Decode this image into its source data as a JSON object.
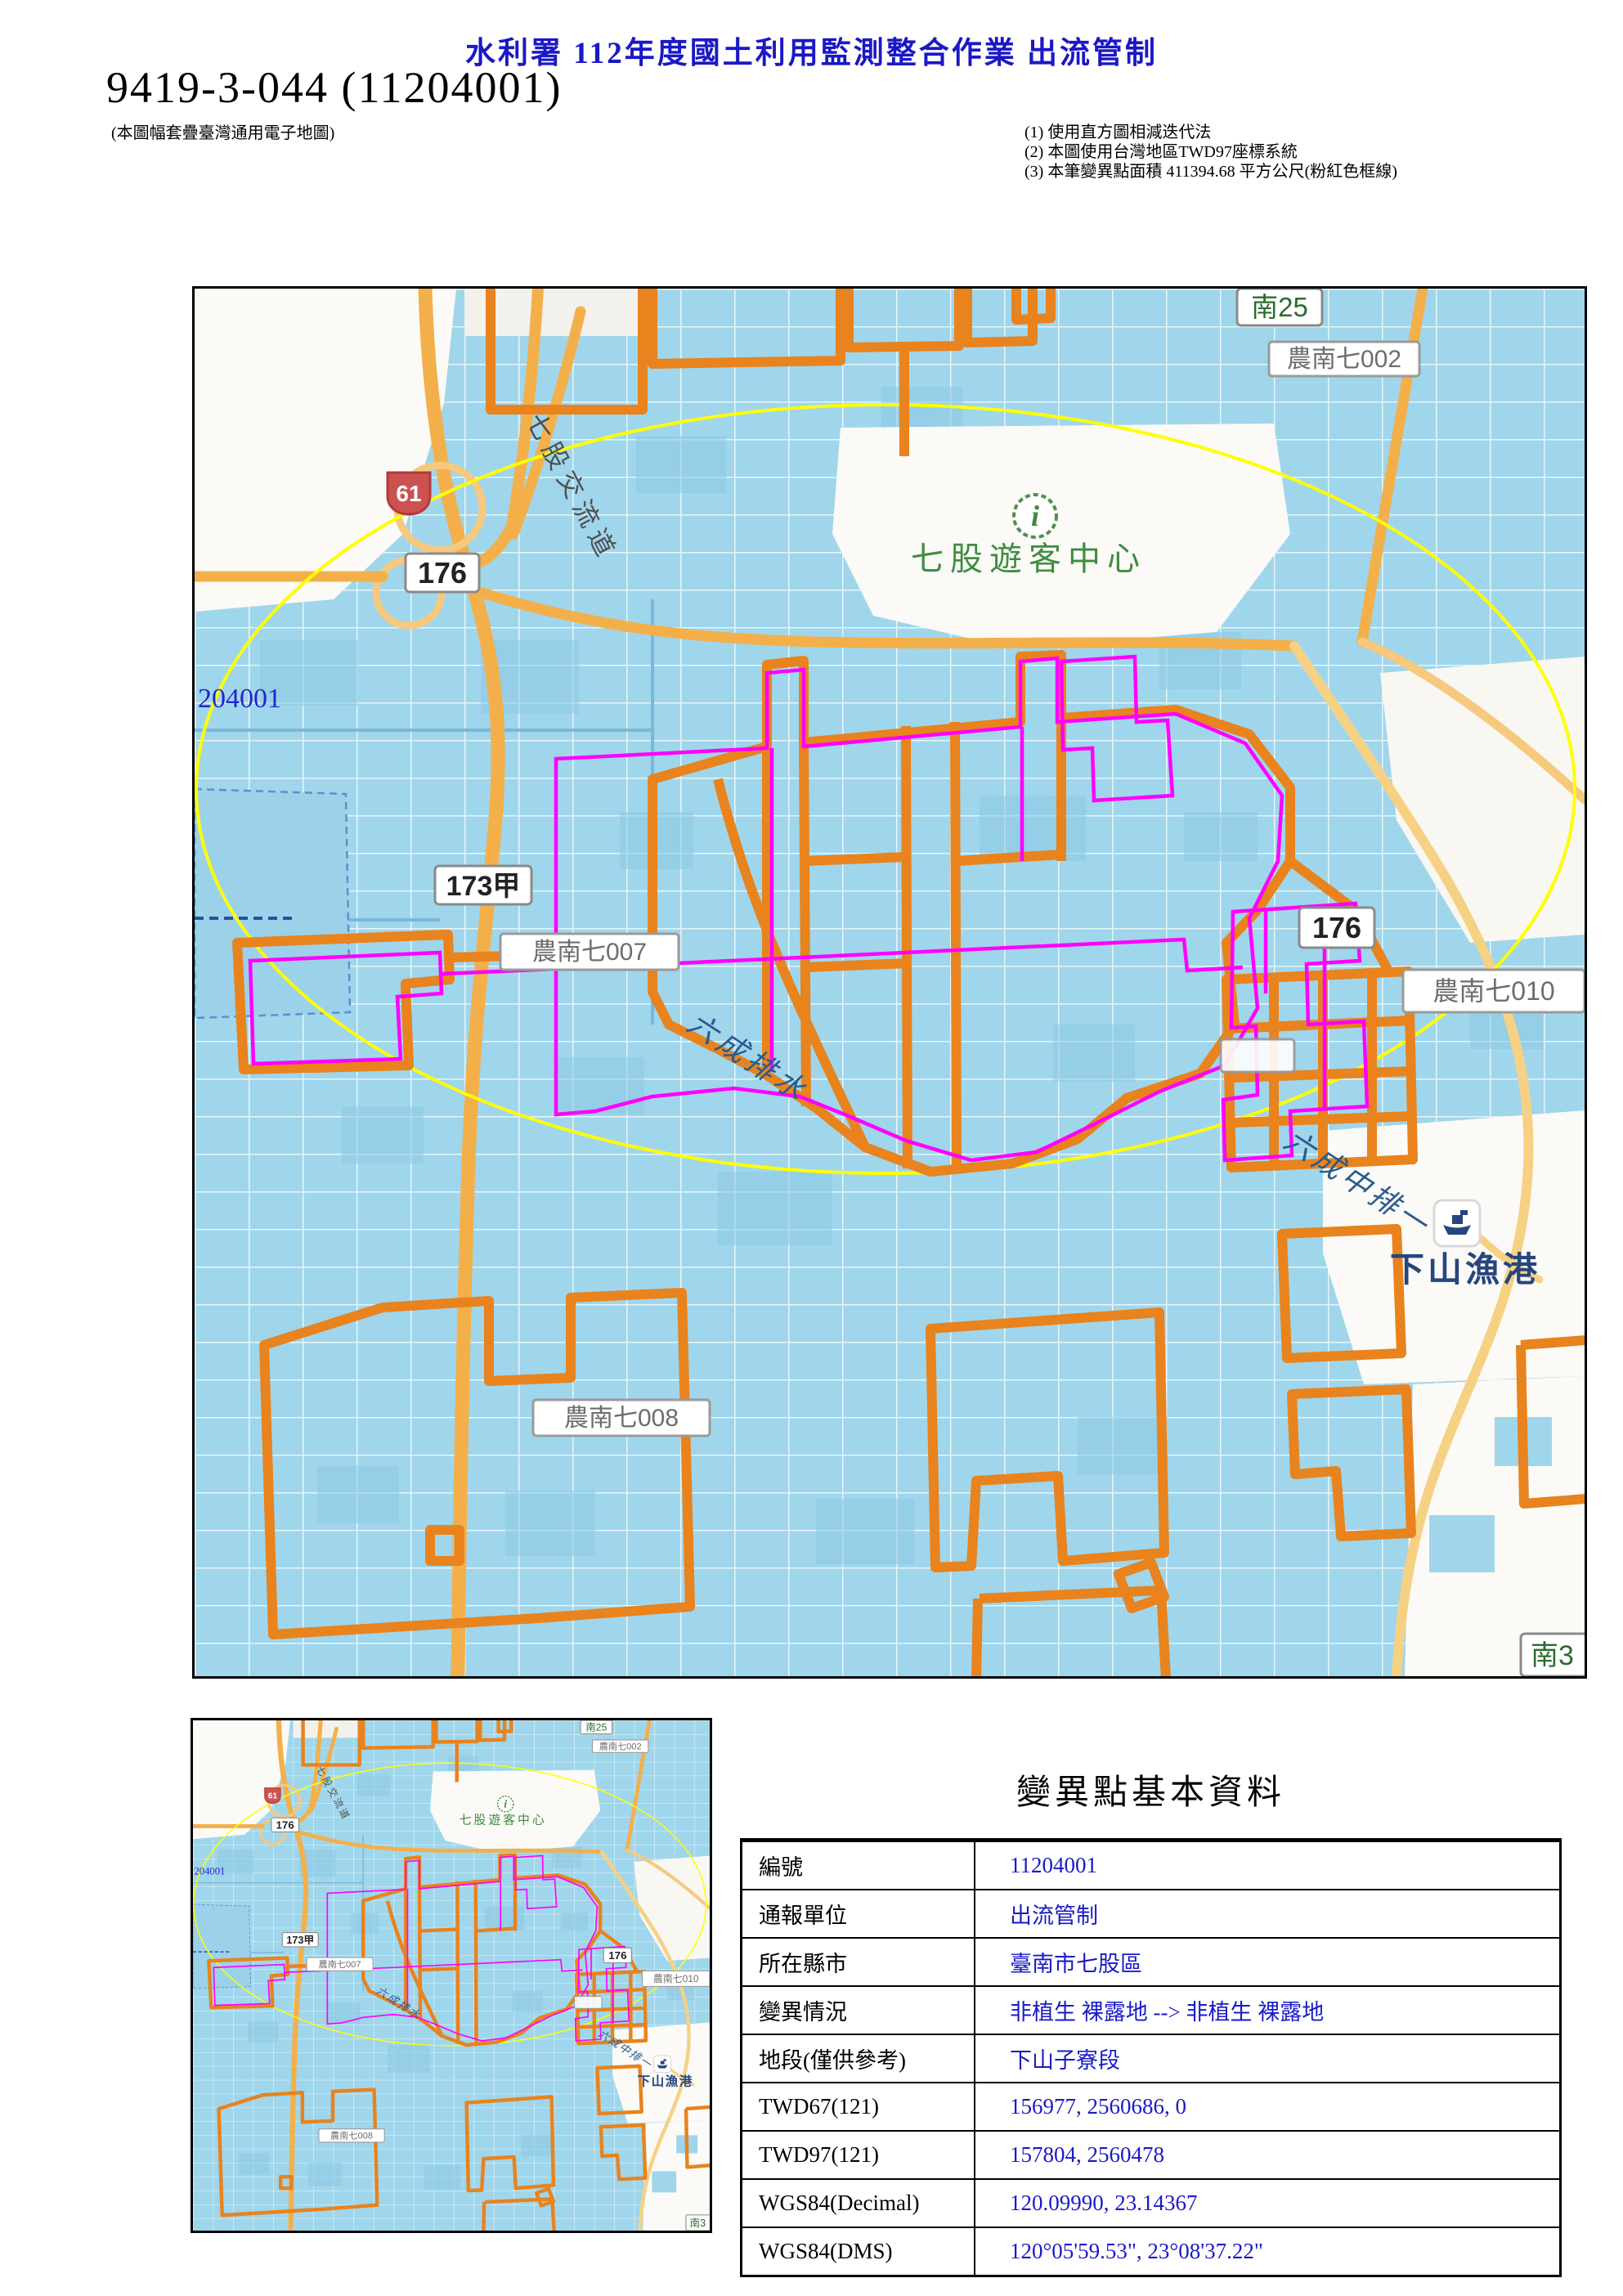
{
  "header": {
    "title": "水利署 112年度國土利用監測整合作業 出流管制",
    "map_id": "9419-3-044 (11204001)",
    "map_id_note": "(本圖幅套疊臺灣通用電子地圖)",
    "notes": {
      "n1": "(1) 使用直方圖相減迭代法",
      "n2": "(2) 本圖使用台灣地區TWD97座標系統",
      "n3": "(3) 本筆變異點面積 411394.68 平方公尺(粉紅色框線)"
    }
  },
  "map": {
    "labels": {
      "sign_nan25": "南25",
      "canal_7002": "農南七002",
      "badge_61": "61",
      "interchange": "七股交流道",
      "sign_176_left": "176",
      "visitor_icon": "i",
      "visitor_center": "七股遊客中心",
      "change_id": "204001",
      "sign_173a": "173甲",
      "canal_7007": "農南七007",
      "sign_176_right": "176",
      "canal_7010": "農南七010",
      "drain_main": "六成排水",
      "drain_branch": "六成中排一",
      "fishing_port": "下山漁港",
      "canal_7008": "農南七008",
      "sign_nan3": "南3"
    },
    "colors": {
      "water": "#a8dbee",
      "change_outline_orange": "#e8831d",
      "change_outline_pink": "#ff00ff",
      "highlight_ellipse": "#ffff00",
      "road_orange": "#f3b04a"
    }
  },
  "info_table": {
    "title": "變異點基本資料",
    "rows": [
      {
        "label": "編號",
        "value": "11204001"
      },
      {
        "label": "通報單位",
        "value": "出流管制"
      },
      {
        "label": "所在縣市",
        "value": "臺南市七股區"
      },
      {
        "label": "變異情況",
        "value": "非植生 裸露地 --> 非植生 裸露地"
      },
      {
        "label": "地段(僅供參考)",
        "value": "下山子寮段"
      },
      {
        "label": "TWD67(121)",
        "value": "156977, 2560686, 0"
      },
      {
        "label": "TWD97(121)",
        "value": "157804, 2560478"
      },
      {
        "label": "WGS84(Decimal)",
        "value": "120.09990, 23.14367"
      },
      {
        "label": "WGS84(DMS)",
        "value": "120°05'59.53\", 23°08'37.22\""
      }
    ]
  }
}
